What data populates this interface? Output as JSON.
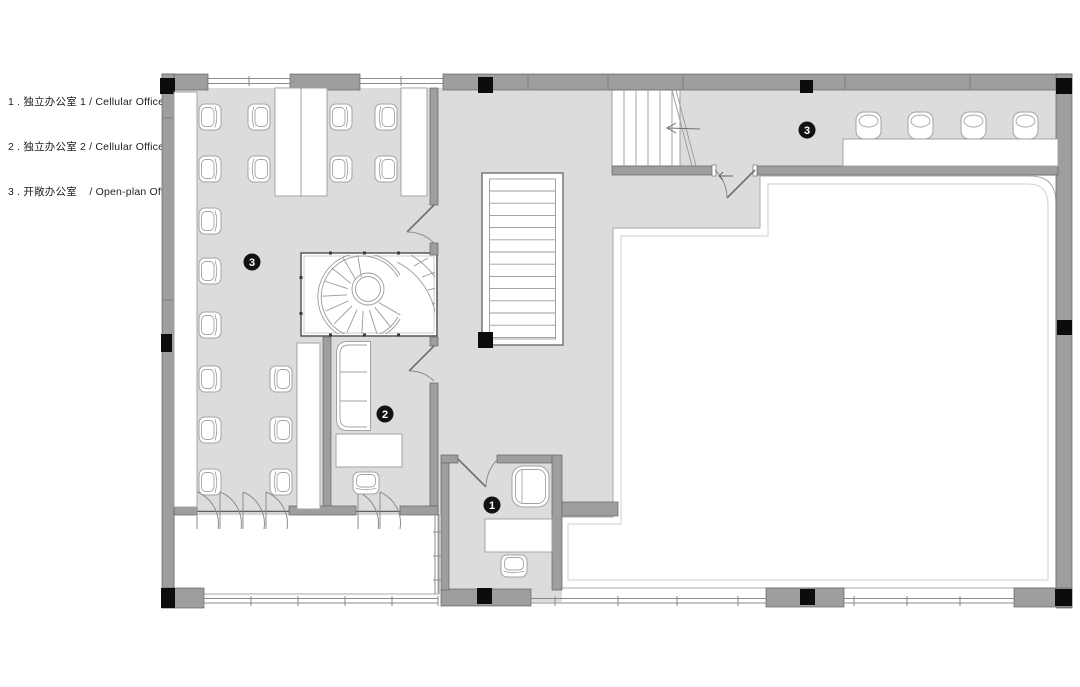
{
  "legend": {
    "items": [
      {
        "number": "1",
        "zh": "独立办公室 1",
        "en": "Cellular Office 1",
        "line": "1 . 独立办公室 1 / Cellular Office 1"
      },
      {
        "number": "2",
        "zh": "独立办公室 2",
        "en": "Cellular Office 2",
        "line": "2 . 独立办公室 2 / Cellular Office 2"
      },
      {
        "number": "3",
        "zh": "开敞办公室",
        "en": "Open-plan Office",
        "line": "3 . 开敞办公室    / Open-plan Office"
      }
    ]
  },
  "rooms": [
    {
      "key": "open-plan-office-left",
      "number": "3"
    },
    {
      "key": "cellular-office-2",
      "number": "2"
    },
    {
      "key": "cellular-office-1",
      "number": "1"
    },
    {
      "key": "open-plan-office-right",
      "number": "3"
    }
  ],
  "colors": {
    "floor": "#dcdcdc",
    "wall": "#9e9e9e",
    "column": "#0c0c0c",
    "furniture_line": "#a3a3a3",
    "label_bg": "#121212",
    "label_text": "#ffffff",
    "text": "#1d1d1d"
  }
}
